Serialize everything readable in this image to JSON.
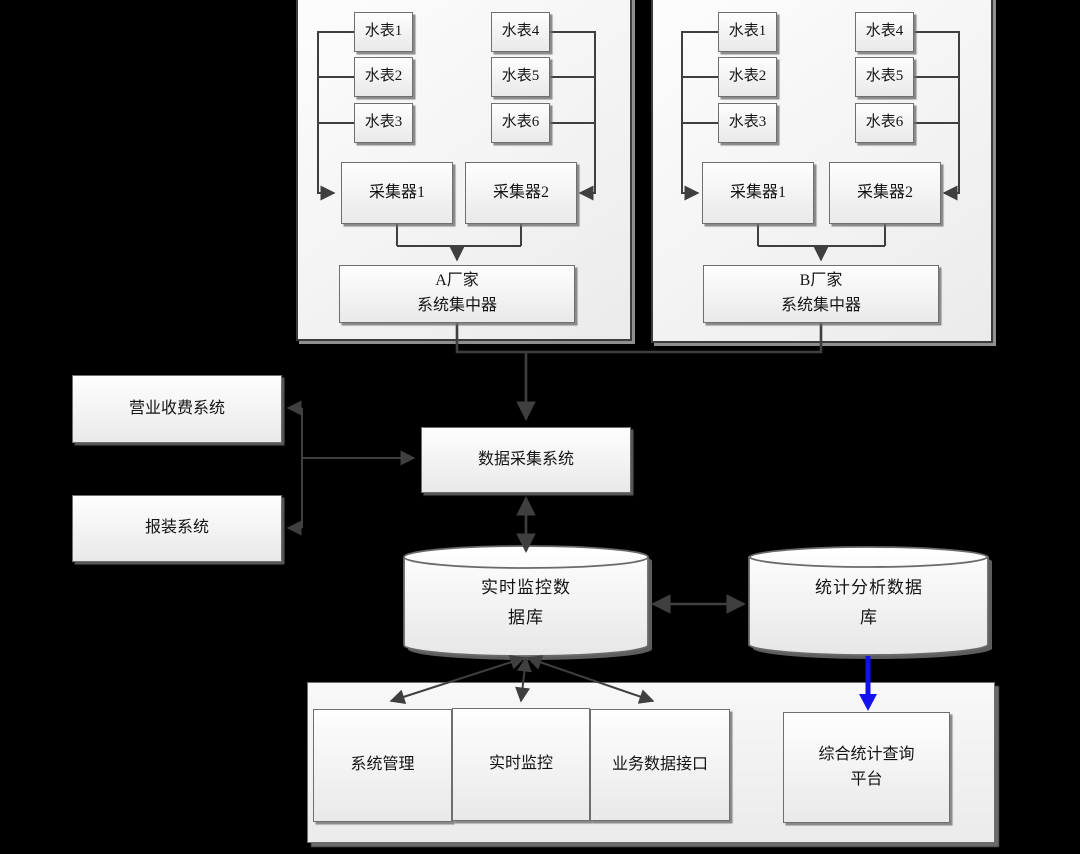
{
  "colors": {
    "background": "#000000",
    "line": "#3f3f3f",
    "blue_arrow": "#1212ee",
    "box_border": "#6f6f6f",
    "group_border": "#3c3c3c"
  },
  "vendor_a": {
    "meters": [
      "水表1",
      "水表2",
      "水表3",
      "水表4",
      "水表5",
      "水表6"
    ],
    "collectors": [
      "采集器1",
      "采集器2"
    ],
    "concentrator": {
      "line1": "A厂家",
      "line2": "系统集中器"
    }
  },
  "vendor_b": {
    "meters": [
      "水表1",
      "水表2",
      "水表3",
      "水表4",
      "水表5",
      "水表6"
    ],
    "collectors": [
      "采集器1",
      "采集器2"
    ],
    "concentrator": {
      "line1": "B厂家",
      "line2": "系统集中器"
    }
  },
  "left_systems": {
    "billing": "营业收费系统",
    "installation": "报装系统"
  },
  "daq": {
    "label": "数据采集系统"
  },
  "databases": {
    "realtime": {
      "line1": "实时监控数",
      "line2": "据库"
    },
    "statistics": {
      "line1": "统计分析数据",
      "line2": "库"
    }
  },
  "modules": {
    "system_management": "系统管理",
    "realtime_monitoring": "实时监控",
    "business_data_interface": "业务数据接口"
  },
  "platform": {
    "line1": "综合统计查询",
    "line2": "平台"
  }
}
